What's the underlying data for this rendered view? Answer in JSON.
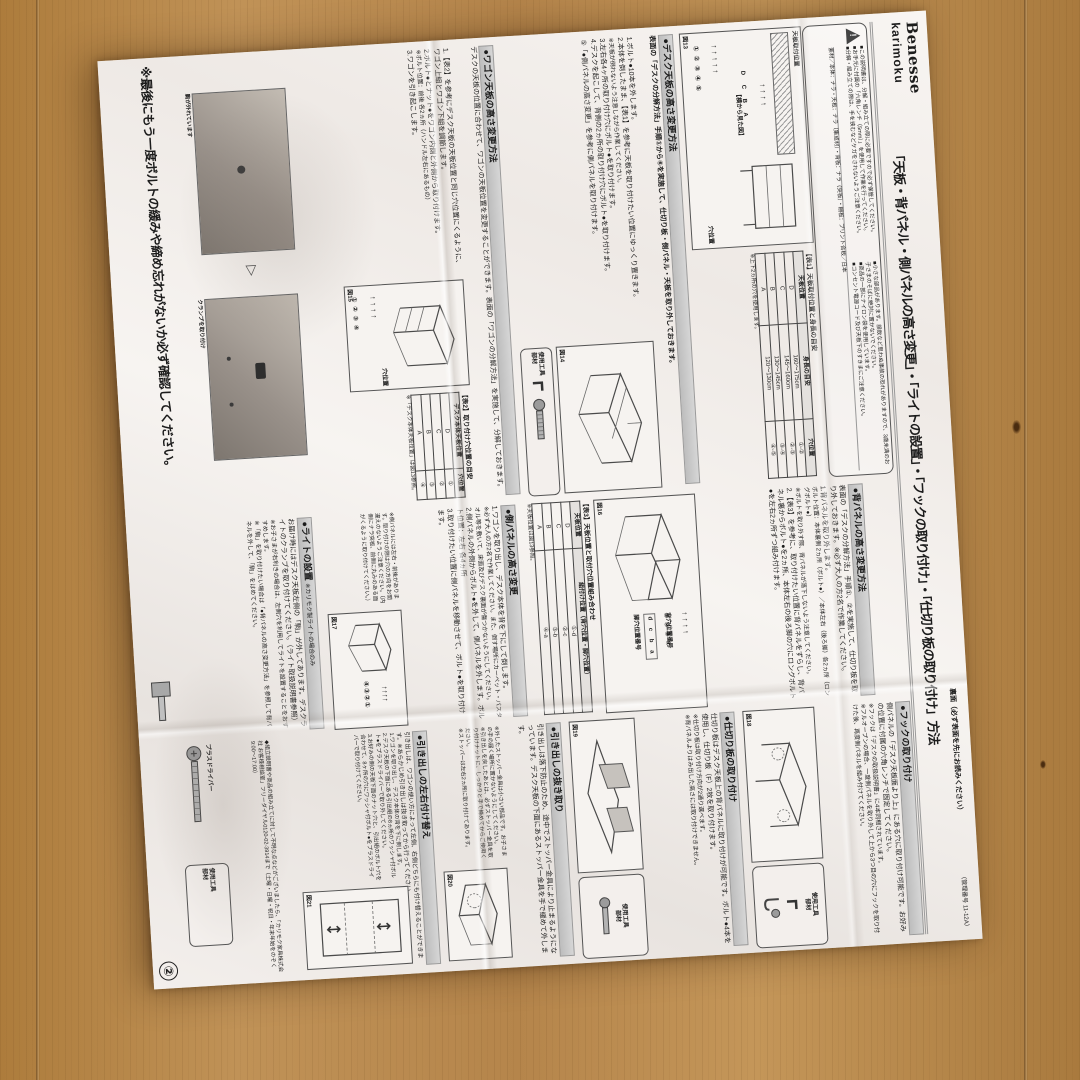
{
  "colors": {
    "wood": "#b5854b",
    "paper": "#f4f1ee",
    "header_bar": "#c9c9c9"
  },
  "header": {
    "brand_top": "Benesse",
    "brand_bottom": "karimoku",
    "title": "「天板・背パネル・側パネルの高さ変更」・「ライトの設置」・「フックの取り付け」・「仕切り板の取り付け」方法",
    "back_note": "裏面（必ず表面を先にお読みください）",
    "doc_no": "（管理番号 11-12A）"
  },
  "notice": {
    "bullets": [
      "■この説明書は、分解・組み立ての際に必要ですので必ず保管してください。",
      "■お手元に付属の「六角レンチ（5mm）」を使用して作業を行ってください。",
      "■分解・組み立ての際は、手を挟むなどケガをされないようご注意ください。",
      "■小さな部品があります。誤飲など思わぬ事故の恐れがありますので、3歳未満のお子さまのそばに絶対に置かないでください。",
      "■商品の一部にナイロン袋を使用しています。",
      "■コンセント電源コード及び天板下のすきまにご注意ください。"
    ],
    "materials": "素材／本体：ナラ・天板：ナラ（集成材）・背板：ナラ（突板）・棚板：プリント合板／日本"
  },
  "tools": {
    "label_l1": "使用工具",
    "label_l2": "部材",
    "screwdriver": "プラスドライバー"
  },
  "sections": {
    "desk_top": {
      "heading": "●デスク天板の高さ変更方法",
      "intro": "表面の「デスクの分解方法」手順①から⑥を実施して、仕切り板・側パネル・天板を取り外しておきます。",
      "step1": "1.ボルト●10本を外します。",
      "step2": "2.本体を倒したまま、【表1】を参考に天板を取り付けたい位置にゆっくり置きます。",
      "step2_note": "※天板が倒れないよう注意しながら作業してください。",
      "step3": "3.左右各4ヶ所の取り付け穴にボルト●を取り付けます。",
      "step4": "4.デスクを起こして、背側の2ヵ所の取り付け穴にボルト●を取り付けます。",
      "step5": "⑤「●側パネルの高さ変更」を参考に側パネルを取り付けます。"
    },
    "wagon_top": {
      "heading": "●ワゴン天板の高さ変更方法",
      "intro": "デスクの天板の位置に合わせて、ワゴンの天板位置を変更することができます。表面の「ワゴンの分解方法」を実施して、分解しておきます。",
      "step1": "1.【表2】を参考にデスク天板の天板位置と同じ穴位置にくるように、ワゴン上組とワゴン下組を調節します。",
      "step2": "2.ボルト●とナット●をワゴン内側と外側から取り付けます。",
      "step2_note": "※ボルト位置：前後 各2ヵ所（ハンドル左右にあるもの）",
      "step3": "3.ワゴンを引き起こします。"
    },
    "back_panel": {
      "heading": "●背パネルの高さ変更方法",
      "intro": "表面の「デスクの分解方法」手順①、②を実施して、仕切り板を取り外しておきます。※必ず大人の方2名で作業してください。",
      "step1": "1.背パネルを取り外します。",
      "bolt_pos": "ボルト位置：本体裏側 2ヵ所（ボルト●）／本体左右（後ろ脚）各2ヵ所（ロングボルト●）",
      "note1": "※ボルトを取り外す際、背パネルが落下しないよう注意してください。",
      "step2": "2.【表3】を参考に、取り付けたい位置に背パネルをずらし、背パネル裏からボルト●を2ヵ所、本体左右の後ろ脚の穴にロングボルト●を左右2ヵ所ずつ組み付けます。"
    },
    "side_panel": {
      "heading": "●側パネルの高さ変更",
      "step1": "1.ワゴンを取り出し、デスク本体を背を下にして倒します。",
      "note1": "※必ず大人の方2名で作業してください。また、倒す場所にカーペット・バスタオル等を敷いて、床面及びデスク裏面が傷つかないようにしてください。",
      "step2": "2.側パネルの外側からボルト●を外して、側パネルを外します。ボルト位置：左右 各4ヵ所",
      "step3": "3.取り付けたい位置に側パネルを移動させて、ボルト●を取り付けます。",
      "note2": "※側パネルには左右・前後があります。取り付けの際は穴の方向をお間違えのないようご注意ください。（内側にナラ突板、前側に丸みのある面がくるように取り付けてください。）"
    },
    "light": {
      "heading": "●ライトの設置",
      "sub": "※カリモク製ライトの場合のみ",
      "body1": "お届け時にはデスク天板左側の「駒」が外してあります。デスクライトのクランプを取り付けてください。（ライト取扱説明書参照）",
      "note1": "※お子さまが右利きの場合は、左側穴を利用してライトを設置することをおすすめします。",
      "note2": "※「駒」を取り付けたい場合は「●背パネルの高さ変更方法」を参照して背パネルを外して、「駒」をはめてください。",
      "img1_label": "駒が外れています",
      "img2_label": "クランプを取り付け"
    },
    "hook": {
      "heading": "●フックの取り付け",
      "body": "側パネルの「デスク天板面より上」にある穴に取り付け可能です。お好みの位置に付属の六角レンチで固定してください。",
      "note1": "※フックは「デスクの取扱説明書」に4本同梱されています。",
      "note2": "※フルオープンの場合、一度側パネルを取り外して上から3つ目の穴にフックを取り付けた後、再度側パネルを組み付けてください。"
    },
    "divider": {
      "heading": "●仕切り板の取り付け",
      "body": "仕切り板はデスク天板上の背パネルに取り付けが可能です。ボルト●4本を使用し、仕切り板（F）2枚を取り付けます。",
      "note1": "※仕切り板は取り付け方向が2通り選べます。",
      "note2": "※背パネルよりはみ出した高さには取り付けできません。"
    },
    "drawer_remove": {
      "heading": "●引き出しの抜き取り",
      "body": "引き出しは落下防止のため、途中でストッパー金具により止まるようになっています。デスク天板の下面にあるストッパー金具を手で緩めて外します。",
      "note1": "※外したストッパー金具は小さい部品です。お子さまの手の届く場所に置かないようにしてください。",
      "note2": "※引き出しを戻したあとは、必ずストッパー金具を取り付けナットに、しっかりと手で締めてからご使用ください。",
      "note3": "※ストッパーは左右2ヵ所に取り付けてあります。"
    },
    "drawer_swap": {
      "heading": "●引き出しの左右付け替え",
      "body": "引き出しは、ワゴンの使い方によって左側、右側どちらにも付け替えることができます。※あらかじめ引き出しは抜き取ってから行ってください。",
      "step1": "1.ワゴンを取り出し、デスク本体の背を下に倒します。",
      "step2": "2.デスク天板の下面にある引出組の8ヵ所のワッシャ付ボルト●をプラスドライバーで取り外してください。",
      "step3": "3.お好みの側の天板下面のナット穴と、引出組のボルト穴を合わせて、8ヶ所の穴にワッシャ付ボルト●をプラスドライバーで取り付けてください。"
    }
  },
  "figures": {
    "f13": {
      "caption": "図13",
      "label": "天板取付位置",
      "sub": "【横から見た図】",
      "hole_label": "穴位置",
      "positions": "D C B A",
      "holes": "① ② ③ ④ ⑤"
    },
    "f14": {
      "caption": "図14"
    },
    "f15": {
      "caption": "図15",
      "hole_label": "穴位置",
      "holes": "① ② ③ ④"
    },
    "f16": {
      "caption": "図16",
      "back_label": "背穴位置番号",
      "leg_label": "脚穴位置番号",
      "holes": "① ② ③ ④",
      "legs": "d c b a"
    },
    "f17": {
      "caption": "図17",
      "holes": "④③②①"
    },
    "f18": {
      "caption": "図18"
    },
    "f19": {
      "caption": "図19"
    },
    "f20": {
      "caption": "図20"
    },
    "f21": {
      "caption": "図21"
    }
  },
  "tables": {
    "t1": {
      "caption": "【表1】天板取付位置と身長の目安",
      "h1": "天板位置",
      "h2": "身長の目安",
      "h3": "穴位置",
      "rows": [
        [
          "D",
          "160～175cm",
          "①-②"
        ],
        [
          "C",
          "145～160cm",
          "②-③"
        ],
        [
          "B",
          "130～145cm",
          "③-④"
        ],
        [
          "A",
          "120～130cm",
          "④-⑤"
        ]
      ],
      "note": "※上下2ヵ所の穴を使用します。"
    },
    "t2": {
      "caption": "【表2】取り付け穴位置の目安",
      "h1": "デスク本体天板位置",
      "h2": "穴位置",
      "rows": [
        [
          "D",
          "①"
        ],
        [
          "C",
          "②"
        ],
        [
          "B",
          "③"
        ],
        [
          "A",
          "④"
        ]
      ],
      "note": "※「デスク本体天板位置」は図13参照。"
    },
    "t3": {
      "caption": "【表3】天板位置と取付穴位置組み合わせ",
      "h1": "天板位置",
      "h2": "組付け位置（背穴位置・脚穴位置）",
      "rows": [
        [
          "D",
          "①-d"
        ],
        [
          "C",
          "②-c"
        ],
        [
          "B",
          "③-b"
        ],
        [
          "A",
          "④-a"
        ]
      ],
      "note": "※天板位置は図13参照。"
    }
  },
  "footer": {
    "final_note": "※最後にもう一度ボルトの緩みや締め忘れがないか必ず確認してください。",
    "contact": "◆組立説明書や商品の組み立てに対して不明な点などがございましたら、「カリモク家具株式会社 お客様相談室」フリーダイヤル0120-02-3914まで（土曜・日曜・祝日・年末年始をのぞく 9:00～17:00）",
    "page": "②"
  }
}
